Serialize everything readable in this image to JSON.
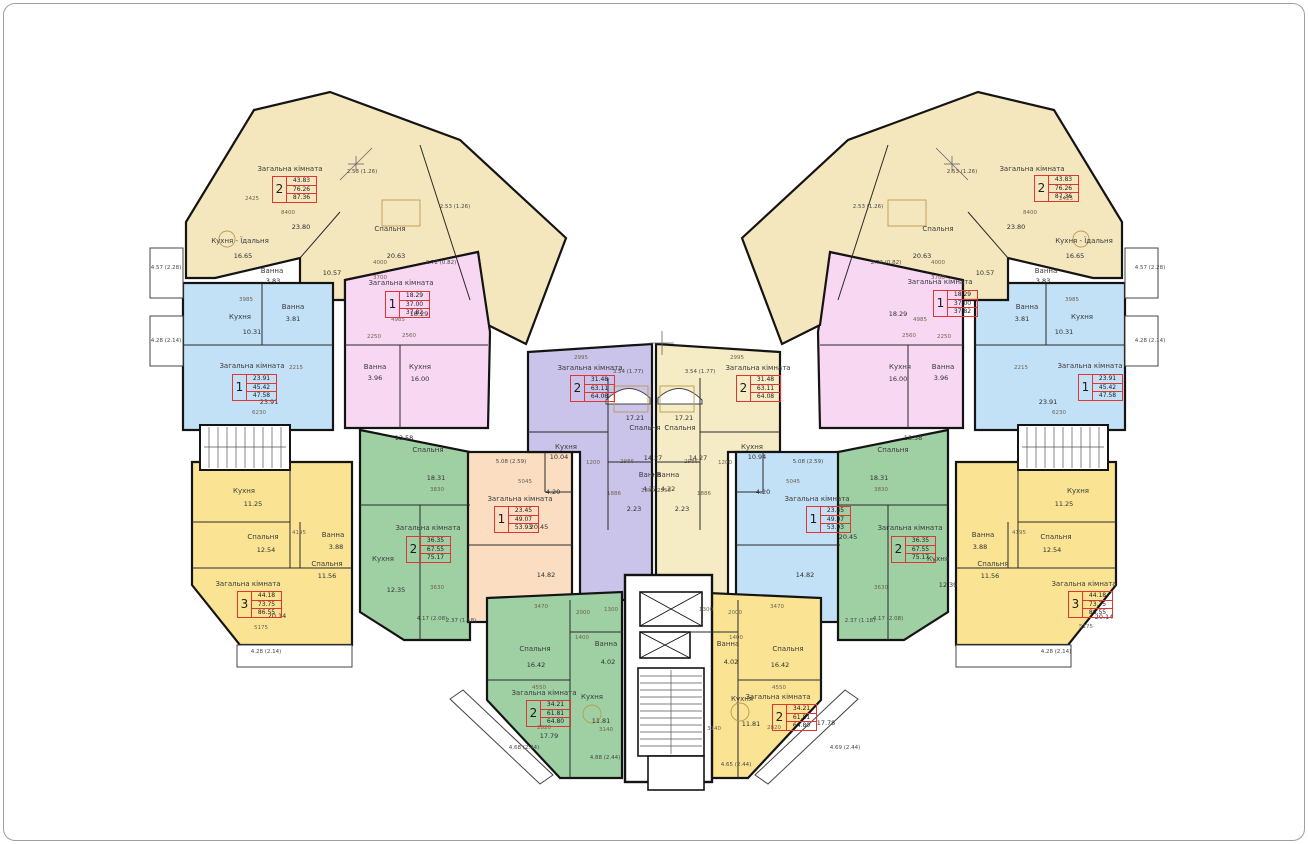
{
  "colors": {
    "wingYellow": "#F5E7BD",
    "yellow": "#FAE493",
    "pink": "#F8D7F2",
    "blue": "#C2E0F6",
    "green": "#9FD0A4",
    "purple": "#CAC3EA",
    "peach": "#FBDEC2",
    "cream": "#F5ECC6",
    "wall": "#141414",
    "accent_red": "#E03535",
    "white": "#FFFFFF",
    "glyph": "#BB9A4E",
    "mark": "#666666"
  },
  "apartments": [
    {
      "id": "top-left-2room",
      "number": "2",
      "living": "43.83",
      "area": "76.26",
      "total": "87.36",
      "x": 272,
      "y": 176
    },
    {
      "id": "left-pink-1room",
      "number": "1",
      "living": "18.29",
      "area": "37.00",
      "total": "37.82",
      "x": 385,
      "y": 291
    },
    {
      "id": "left-blue-1room",
      "number": "1",
      "living": "23.91",
      "area": "45.42",
      "total": "47.58",
      "x": 232,
      "y": 374
    },
    {
      "id": "left-3room",
      "number": "3",
      "living": "44.18",
      "area": "73.75",
      "total": "86.55",
      "x": 237,
      "y": 591
    },
    {
      "id": "left-green-2room",
      "number": "2",
      "living": "36.35",
      "area": "67.55",
      "total": "75.17",
      "x": 406,
      "y": 536
    },
    {
      "id": "center-left-peach-1room",
      "number": "1",
      "living": "23.45",
      "area": "49.07",
      "total": "53.93",
      "x": 494,
      "y": 506
    },
    {
      "id": "center-purple-2room",
      "number": "2",
      "living": "31.48",
      "area": "63.11",
      "total": "64.08",
      "x": 570,
      "y": 375
    },
    {
      "id": "center-cream-2room",
      "number": "2",
      "living": "31.48",
      "area": "63.11",
      "total": "64.08",
      "x": 736,
      "y": 375
    },
    {
      "id": "center-right-blue-1room",
      "number": "1",
      "living": "23.45",
      "area": "49.07",
      "total": "53.93",
      "x": 806,
      "y": 506
    },
    {
      "id": "right-green-2room",
      "number": "2",
      "living": "36.35",
      "area": "67.55",
      "total": "75.17",
      "x": 891,
      "y": 536
    },
    {
      "id": "right-3room",
      "number": "3",
      "living": "44.18",
      "area": "73.75",
      "total": "86.55",
      "x": 1068,
      "y": 591
    },
    {
      "id": "right-blue-1room",
      "number": "1",
      "living": "23.91",
      "area": "45.42",
      "total": "47.58",
      "x": 1078,
      "y": 374
    },
    {
      "id": "right-pink-1room",
      "number": "1",
      "living": "18.29",
      "area": "37.00",
      "total": "37.82",
      "x": 933,
      "y": 290
    },
    {
      "id": "top-right-2room",
      "number": "2",
      "living": "43.83",
      "area": "76.26",
      "total": "87.36",
      "x": 1034,
      "y": 175
    },
    {
      "id": "bottom-left-green-2room",
      "number": "2",
      "living": "34.21",
      "area": "61.81",
      "total": "64.80",
      "x": 526,
      "y": 700
    },
    {
      "id": "bottom-right-yellow-2room",
      "number": "2",
      "living": "34.21",
      "area": "61.81",
      "total": "64.80",
      "x": 772,
      "y": 704
    }
  ],
  "room_labels": [
    {
      "t": "Загальна кімната",
      "x": 290,
      "y": 169
    },
    {
      "t": "Кухня - Їдальня",
      "x": 240,
      "y": 241
    },
    {
      "t": "Спальня",
      "x": 390,
      "y": 229
    },
    {
      "t": "Ванна",
      "x": 272,
      "y": 271
    },
    {
      "t": "Загальна кімната",
      "x": 401,
      "y": 283
    },
    {
      "t": "Ванна",
      "x": 375,
      "y": 367
    },
    {
      "t": "Кухня",
      "x": 420,
      "y": 367
    },
    {
      "t": "Кухня",
      "x": 240,
      "y": 317
    },
    {
      "t": "Ванна",
      "x": 293,
      "y": 307
    },
    {
      "t": "Загальна кімната",
      "x": 252,
      "y": 366
    },
    {
      "t": "Кухня",
      "x": 244,
      "y": 491
    },
    {
      "t": "Спальня",
      "x": 263,
      "y": 537
    },
    {
      "t": "Ванна",
      "x": 333,
      "y": 535
    },
    {
      "t": "Спальня",
      "x": 327,
      "y": 564
    },
    {
      "t": "Загальна кімната",
      "x": 248,
      "y": 584
    },
    {
      "t": "Спальня",
      "x": 428,
      "y": 450
    },
    {
      "t": "Кухня",
      "x": 383,
      "y": 559
    },
    {
      "t": "Загальна кімната",
      "x": 428,
      "y": 528
    },
    {
      "t": "Загальна кімната",
      "x": 520,
      "y": 499
    },
    {
      "t": "Загальна кімната",
      "x": 590,
      "y": 368
    },
    {
      "t": "Спальня",
      "x": 645,
      "y": 428
    },
    {
      "t": "Кухня",
      "x": 566,
      "y": 447
    },
    {
      "t": "Ванна",
      "x": 650,
      "y": 475
    },
    {
      "t": "Загальна кімната",
      "x": 758,
      "y": 368
    },
    {
      "t": "Спальня",
      "x": 680,
      "y": 428
    },
    {
      "t": "Кухня",
      "x": 752,
      "y": 447
    },
    {
      "t": "Ванна",
      "x": 668,
      "y": 475
    },
    {
      "t": "Загальна кімната",
      "x": 817,
      "y": 499
    },
    {
      "t": "Спальня",
      "x": 893,
      "y": 450
    },
    {
      "t": "Кухня",
      "x": 938,
      "y": 559
    },
    {
      "t": "Загальна кімната",
      "x": 910,
      "y": 528
    },
    {
      "t": "Кухня",
      "x": 1078,
      "y": 491
    },
    {
      "t": "Спальня",
      "x": 1056,
      "y": 537
    },
    {
      "t": "Ванна",
      "x": 983,
      "y": 535
    },
    {
      "t": "Спальня",
      "x": 993,
      "y": 564
    },
    {
      "t": "Загальна кімната",
      "x": 1084,
      "y": 584
    },
    {
      "t": "Кухня",
      "x": 1082,
      "y": 317
    },
    {
      "t": "Ванна",
      "x": 1027,
      "y": 307
    },
    {
      "t": "Загальна кімната",
      "x": 1090,
      "y": 366
    },
    {
      "t": "Загальна кімната",
      "x": 940,
      "y": 282
    },
    {
      "t": "Ванна",
      "x": 943,
      "y": 367
    },
    {
      "t": "Кухня",
      "x": 900,
      "y": 367
    },
    {
      "t": "Загальна кімната",
      "x": 1032,
      "y": 169
    },
    {
      "t": "Кухня - Їдальня",
      "x": 1084,
      "y": 241
    },
    {
      "t": "Спальня",
      "x": 938,
      "y": 229
    },
    {
      "t": "Ванна",
      "x": 1046,
      "y": 271
    },
    {
      "t": "Спальня",
      "x": 535,
      "y": 649
    },
    {
      "t": "Ванна",
      "x": 606,
      "y": 644
    },
    {
      "t": "Кухня",
      "x": 592,
      "y": 697
    },
    {
      "t": "Загальна кімната",
      "x": 544,
      "y": 693
    },
    {
      "t": "Спальня",
      "x": 788,
      "y": 649
    },
    {
      "t": "Ванна",
      "x": 728,
      "y": 644
    },
    {
      "t": "Кухня",
      "x": 742,
      "y": 699
    },
    {
      "t": "Загальна кімната",
      "x": 778,
      "y": 697
    }
  ],
  "area_labels": [
    {
      "t": "16.65",
      "x": 243,
      "y": 256
    },
    {
      "t": "20.63",
      "x": 396,
      "y": 256
    },
    {
      "t": "3.83",
      "x": 273,
      "y": 281
    },
    {
      "t": "10.57",
      "x": 332,
      "y": 273
    },
    {
      "t": "23.80",
      "x": 301,
      "y": 227
    },
    {
      "t": "18.29",
      "x": 419,
      "y": 314
    },
    {
      "t": "3.96",
      "x": 375,
      "y": 378
    },
    {
      "t": "16.00",
      "x": 420,
      "y": 379
    },
    {
      "t": "10.31",
      "x": 252,
      "y": 332
    },
    {
      "t": "3.81",
      "x": 293,
      "y": 319
    },
    {
      "t": "23.91",
      "x": 269,
      "y": 402
    },
    {
      "t": "11.25",
      "x": 253,
      "y": 504
    },
    {
      "t": "12.54",
      "x": 266,
      "y": 550
    },
    {
      "t": "3.88",
      "x": 336,
      "y": 547
    },
    {
      "t": "11.56",
      "x": 327,
      "y": 576
    },
    {
      "t": "20.14",
      "x": 277,
      "y": 616
    },
    {
      "t": "13.58",
      "x": 404,
      "y": 438
    },
    {
      "t": "18.31",
      "x": 436,
      "y": 478
    },
    {
      "t": "12.35",
      "x": 396,
      "y": 590
    },
    {
      "t": "20.45",
      "x": 539,
      "y": 527
    },
    {
      "t": "14.82",
      "x": 546,
      "y": 575
    },
    {
      "t": "4.20",
      "x": 553,
      "y": 492
    },
    {
      "t": "17.21",
      "x": 635,
      "y": 418
    },
    {
      "t": "10.04",
      "x": 559,
      "y": 457
    },
    {
      "t": "4.22",
      "x": 650,
      "y": 489
    },
    {
      "t": "14.27",
      "x": 653,
      "y": 458
    },
    {
      "t": "2.23",
      "x": 634,
      "y": 509
    },
    {
      "t": "17.21",
      "x": 684,
      "y": 418
    },
    {
      "t": "10.94",
      "x": 757,
      "y": 457
    },
    {
      "t": "4.22",
      "x": 668,
      "y": 489
    },
    {
      "t": "14.27",
      "x": 698,
      "y": 458
    },
    {
      "t": "2.23",
      "x": 682,
      "y": 509
    },
    {
      "t": "20.45",
      "x": 848,
      "y": 537
    },
    {
      "t": "14.82",
      "x": 805,
      "y": 575
    },
    {
      "t": "4.20",
      "x": 763,
      "y": 492
    },
    {
      "t": "13.58",
      "x": 913,
      "y": 438
    },
    {
      "t": "18.31",
      "x": 879,
      "y": 478
    },
    {
      "t": "12.39",
      "x": 948,
      "y": 585
    },
    {
      "t": "11.25",
      "x": 1064,
      "y": 504
    },
    {
      "t": "12.54",
      "x": 1052,
      "y": 550
    },
    {
      "t": "3.88",
      "x": 980,
      "y": 547
    },
    {
      "t": "11.56",
      "x": 990,
      "y": 576
    },
    {
      "t": "20.14",
      "x": 1104,
      "y": 617
    },
    {
      "t": "10.31",
      "x": 1064,
      "y": 332
    },
    {
      "t": "3.81",
      "x": 1022,
      "y": 319
    },
    {
      "t": "23.91",
      "x": 1048,
      "y": 402
    },
    {
      "t": "18.29",
      "x": 898,
      "y": 314
    },
    {
      "t": "3.96",
      "x": 941,
      "y": 378
    },
    {
      "t": "16.00",
      "x": 898,
      "y": 379
    },
    {
      "t": "16.65",
      "x": 1075,
      "y": 256
    },
    {
      "t": "20.63",
      "x": 922,
      "y": 256
    },
    {
      "t": "3.83",
      "x": 1043,
      "y": 281
    },
    {
      "t": "10.57",
      "x": 985,
      "y": 273
    },
    {
      "t": "23.80",
      "x": 1016,
      "y": 227
    },
    {
      "t": "16.42",
      "x": 536,
      "y": 665
    },
    {
      "t": "4.02",
      "x": 608,
      "y": 662
    },
    {
      "t": "11.81",
      "x": 601,
      "y": 721
    },
    {
      "t": "17.79",
      "x": 549,
      "y": 736
    },
    {
      "t": "16.42",
      "x": 780,
      "y": 665
    },
    {
      "t": "4.02",
      "x": 731,
      "y": 662
    },
    {
      "t": "11.81",
      "x": 751,
      "y": 724
    },
    {
      "t": "17.78",
      "x": 826,
      "y": 723
    }
  ],
  "dimension_labels": [
    {
      "t": "8400",
      "x": 288,
      "y": 213
    },
    {
      "t": "2425",
      "x": 252,
      "y": 199
    },
    {
      "t": "4000",
      "x": 380,
      "y": 263
    },
    {
      "t": "3700",
      "x": 380,
      "y": 278
    },
    {
      "t": "4985",
      "x": 398,
      "y": 320
    },
    {
      "t": "2250",
      "x": 374,
      "y": 337
    },
    {
      "t": "2560",
      "x": 409,
      "y": 336
    },
    {
      "t": "3985",
      "x": 246,
      "y": 300
    },
    {
      "t": "6230",
      "x": 259,
      "y": 413
    },
    {
      "t": "2215",
      "x": 296,
      "y": 368
    },
    {
      "t": "5175",
      "x": 261,
      "y": 628
    },
    {
      "t": "4195",
      "x": 299,
      "y": 533
    },
    {
      "t": "3830",
      "x": 437,
      "y": 490
    },
    {
      "t": "3630",
      "x": 437,
      "y": 588
    },
    {
      "t": "5045",
      "x": 525,
      "y": 482
    },
    {
      "t": "2995",
      "x": 581,
      "y": 358
    },
    {
      "t": "1200",
      "x": 593,
      "y": 463
    },
    {
      "t": "2986",
      "x": 627,
      "y": 462
    },
    {
      "t": "1886",
      "x": 614,
      "y": 494
    },
    {
      "t": "2250",
      "x": 648,
      "y": 491
    },
    {
      "t": "2995",
      "x": 737,
      "y": 358
    },
    {
      "t": "1200",
      "x": 725,
      "y": 463
    },
    {
      "t": "2986",
      "x": 691,
      "y": 462
    },
    {
      "t": "1886",
      "x": 704,
      "y": 494
    },
    {
      "t": "2250",
      "x": 664,
      "y": 491
    },
    {
      "t": "5045",
      "x": 793,
      "y": 482
    },
    {
      "t": "6230",
      "x": 1059,
      "y": 413
    },
    {
      "t": "2215",
      "x": 1021,
      "y": 368
    },
    {
      "t": "3985",
      "x": 1072,
      "y": 300
    },
    {
      "t": "5175",
      "x": 1086,
      "y": 627
    },
    {
      "t": "4195",
      "x": 1019,
      "y": 533
    },
    {
      "t": "3830",
      "x": 881,
      "y": 490
    },
    {
      "t": "3630",
      "x": 881,
      "y": 588
    },
    {
      "t": "8400",
      "x": 1030,
      "y": 213
    },
    {
      "t": "2425",
      "x": 1066,
      "y": 199
    },
    {
      "t": "4000",
      "x": 938,
      "y": 263
    },
    {
      "t": "3700",
      "x": 938,
      "y": 278
    },
    {
      "t": "4985",
      "x": 920,
      "y": 320
    },
    {
      "t": "2250",
      "x": 944,
      "y": 337
    },
    {
      "t": "2560",
      "x": 909,
      "y": 336
    },
    {
      "t": "3470",
      "x": 541,
      "y": 607
    },
    {
      "t": "2000",
      "x": 583,
      "y": 613
    },
    {
      "t": "1300",
      "x": 611,
      "y": 610
    },
    {
      "t": "1400",
      "x": 582,
      "y": 638
    },
    {
      "t": "4550",
      "x": 539,
      "y": 688
    },
    {
      "t": "2820",
      "x": 544,
      "y": 728
    },
    {
      "t": "3140",
      "x": 606,
      "y": 730
    },
    {
      "t": "3470",
      "x": 777,
      "y": 607
    },
    {
      "t": "2000",
      "x": 735,
      "y": 613
    },
    {
      "t": "1300",
      "x": 706,
      "y": 610
    },
    {
      "t": "1400",
      "x": 736,
      "y": 638
    },
    {
      "t": "4550",
      "x": 779,
      "y": 688
    },
    {
      "t": "2820",
      "x": 774,
      "y": 728
    },
    {
      "t": "3140",
      "x": 714,
      "y": 729
    }
  ],
  "balcony_labels": [
    {
      "t": "4.57 (2.28)",
      "x": 166,
      "y": 268
    },
    {
      "t": "4.28 (2.14)",
      "x": 166,
      "y": 341
    },
    {
      "t": "2.53 (1.26)",
      "x": 362,
      "y": 172
    },
    {
      "t": "2.53 (1.26)",
      "x": 455,
      "y": 207
    },
    {
      "t": "2.72 (0.82)",
      "x": 441,
      "y": 263
    },
    {
      "t": "3.54 (1.77)",
      "x": 628,
      "y": 372
    },
    {
      "t": "3.54 (1.77)",
      "x": 700,
      "y": 372
    },
    {
      "t": "5.08 (2.59)",
      "x": 511,
      "y": 462
    },
    {
      "t": "4.17 (2.08)",
      "x": 432,
      "y": 619
    },
    {
      "t": "2.37 (1.18)",
      "x": 461,
      "y": 621
    },
    {
      "t": "4.28 (2.14)",
      "x": 266,
      "y": 652
    },
    {
      "t": "4.68 (2.44)",
      "x": 524,
      "y": 748
    },
    {
      "t": "4.88 (2.44)",
      "x": 605,
      "y": 758
    },
    {
      "t": "4.65 (2.44)",
      "x": 736,
      "y": 765
    },
    {
      "t": "4.69 (2.44)",
      "x": 845,
      "y": 748
    },
    {
      "t": "2.37 (1.18)",
      "x": 860,
      "y": 621
    },
    {
      "t": "4.17 (2.08)",
      "x": 888,
      "y": 619
    },
    {
      "t": "5.08 (2.59)",
      "x": 808,
      "y": 462
    },
    {
      "t": "2.72 (0.82)",
      "x": 886,
      "y": 263
    },
    {
      "t": "2.53 (1.26)",
      "x": 962,
      "y": 172
    },
    {
      "t": "2.53 (1.26)",
      "x": 868,
      "y": 207
    },
    {
      "t": "4.57 (2.28)",
      "x": 1150,
      "y": 268
    },
    {
      "t": "4.28 (2.14)",
      "x": 1150,
      "y": 341
    },
    {
      "t": "4.28 (2.14)",
      "x": 1056,
      "y": 652
    }
  ]
}
